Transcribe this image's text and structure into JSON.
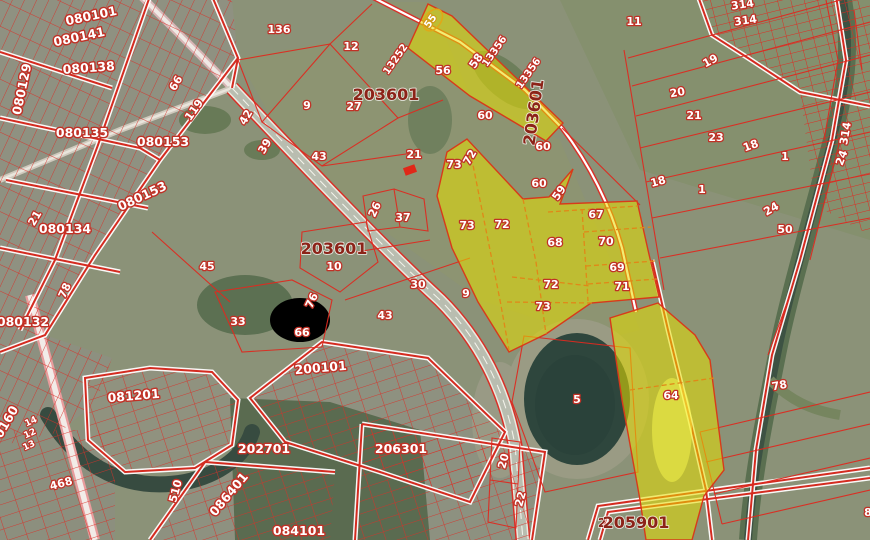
{
  "map": {
    "kind": "public-cadastral-map-satellite-view",
    "highlight_color": "#e8de00",
    "boundary_color": "#d42b20",
    "quarter_label_color": "#ffffff",
    "block_label_color": "#8c2318"
  },
  "labels": [
    {
      "text": "080101"
    },
    {
      "text": "080141"
    },
    {
      "text": "080138"
    },
    {
      "text": "080129"
    },
    {
      "text": "080135"
    },
    {
      "text": "080153"
    },
    {
      "text": "119"
    },
    {
      "text": "66"
    },
    {
      "text": "21"
    },
    {
      "text": "080134"
    },
    {
      "text": "080153"
    },
    {
      "text": "78"
    },
    {
      "text": "080132"
    },
    {
      "text": "45"
    },
    {
      "text": "0160"
    },
    {
      "text": "14"
    },
    {
      "text": "12"
    },
    {
      "text": "13"
    },
    {
      "text": "081201"
    },
    {
      "text": "468"
    },
    {
      "text": "510"
    },
    {
      "text": "086401"
    },
    {
      "text": "084101"
    },
    {
      "text": "202701"
    },
    {
      "text": "200101"
    },
    {
      "text": "206301"
    },
    {
      "text": "2"
    },
    {
      "text": "205901"
    },
    {
      "text": "136"
    },
    {
      "text": "12"
    },
    {
      "text": "9"
    },
    {
      "text": "27"
    },
    {
      "text": "203601"
    },
    {
      "text": "42"
    },
    {
      "text": "39"
    },
    {
      "text": "43"
    },
    {
      "text": "21"
    },
    {
      "text": "26"
    },
    {
      "text": "37"
    },
    {
      "text": "203601"
    },
    {
      "text": "10"
    },
    {
      "text": "33"
    },
    {
      "text": "76"
    },
    {
      "text": "66"
    },
    {
      "text": "30"
    },
    {
      "text": "43"
    },
    {
      "text": "9"
    },
    {
      "text": "56"
    },
    {
      "text": "58"
    },
    {
      "text": "13356"
    },
    {
      "text": "13356"
    },
    {
      "text": "13252"
    },
    {
      "text": "203601"
    },
    {
      "text": "55"
    },
    {
      "text": "60"
    },
    {
      "text": "60"
    },
    {
      "text": "60"
    },
    {
      "text": "59"
    },
    {
      "text": "73"
    },
    {
      "text": "72"
    },
    {
      "text": "73"
    },
    {
      "text": "72"
    },
    {
      "text": "68"
    },
    {
      "text": "67"
    },
    {
      "text": "70"
    },
    {
      "text": "69"
    },
    {
      "text": "71"
    },
    {
      "text": "72"
    },
    {
      "text": "73"
    },
    {
      "text": "5"
    },
    {
      "text": "64"
    },
    {
      "text": "20"
    },
    {
      "text": "22"
    },
    {
      "text": "11"
    },
    {
      "text": "314"
    },
    {
      "text": "314"
    },
    {
      "text": "19"
    },
    {
      "text": "20"
    },
    {
      "text": "21"
    },
    {
      "text": "23"
    },
    {
      "text": "18"
    },
    {
      "text": "1"
    },
    {
      "text": "18"
    },
    {
      "text": "1"
    },
    {
      "text": "24"
    },
    {
      "text": "50"
    },
    {
      "text": "314"
    },
    {
      "text": "24"
    },
    {
      "text": "78"
    },
    {
      "text": "8"
    }
  ]
}
